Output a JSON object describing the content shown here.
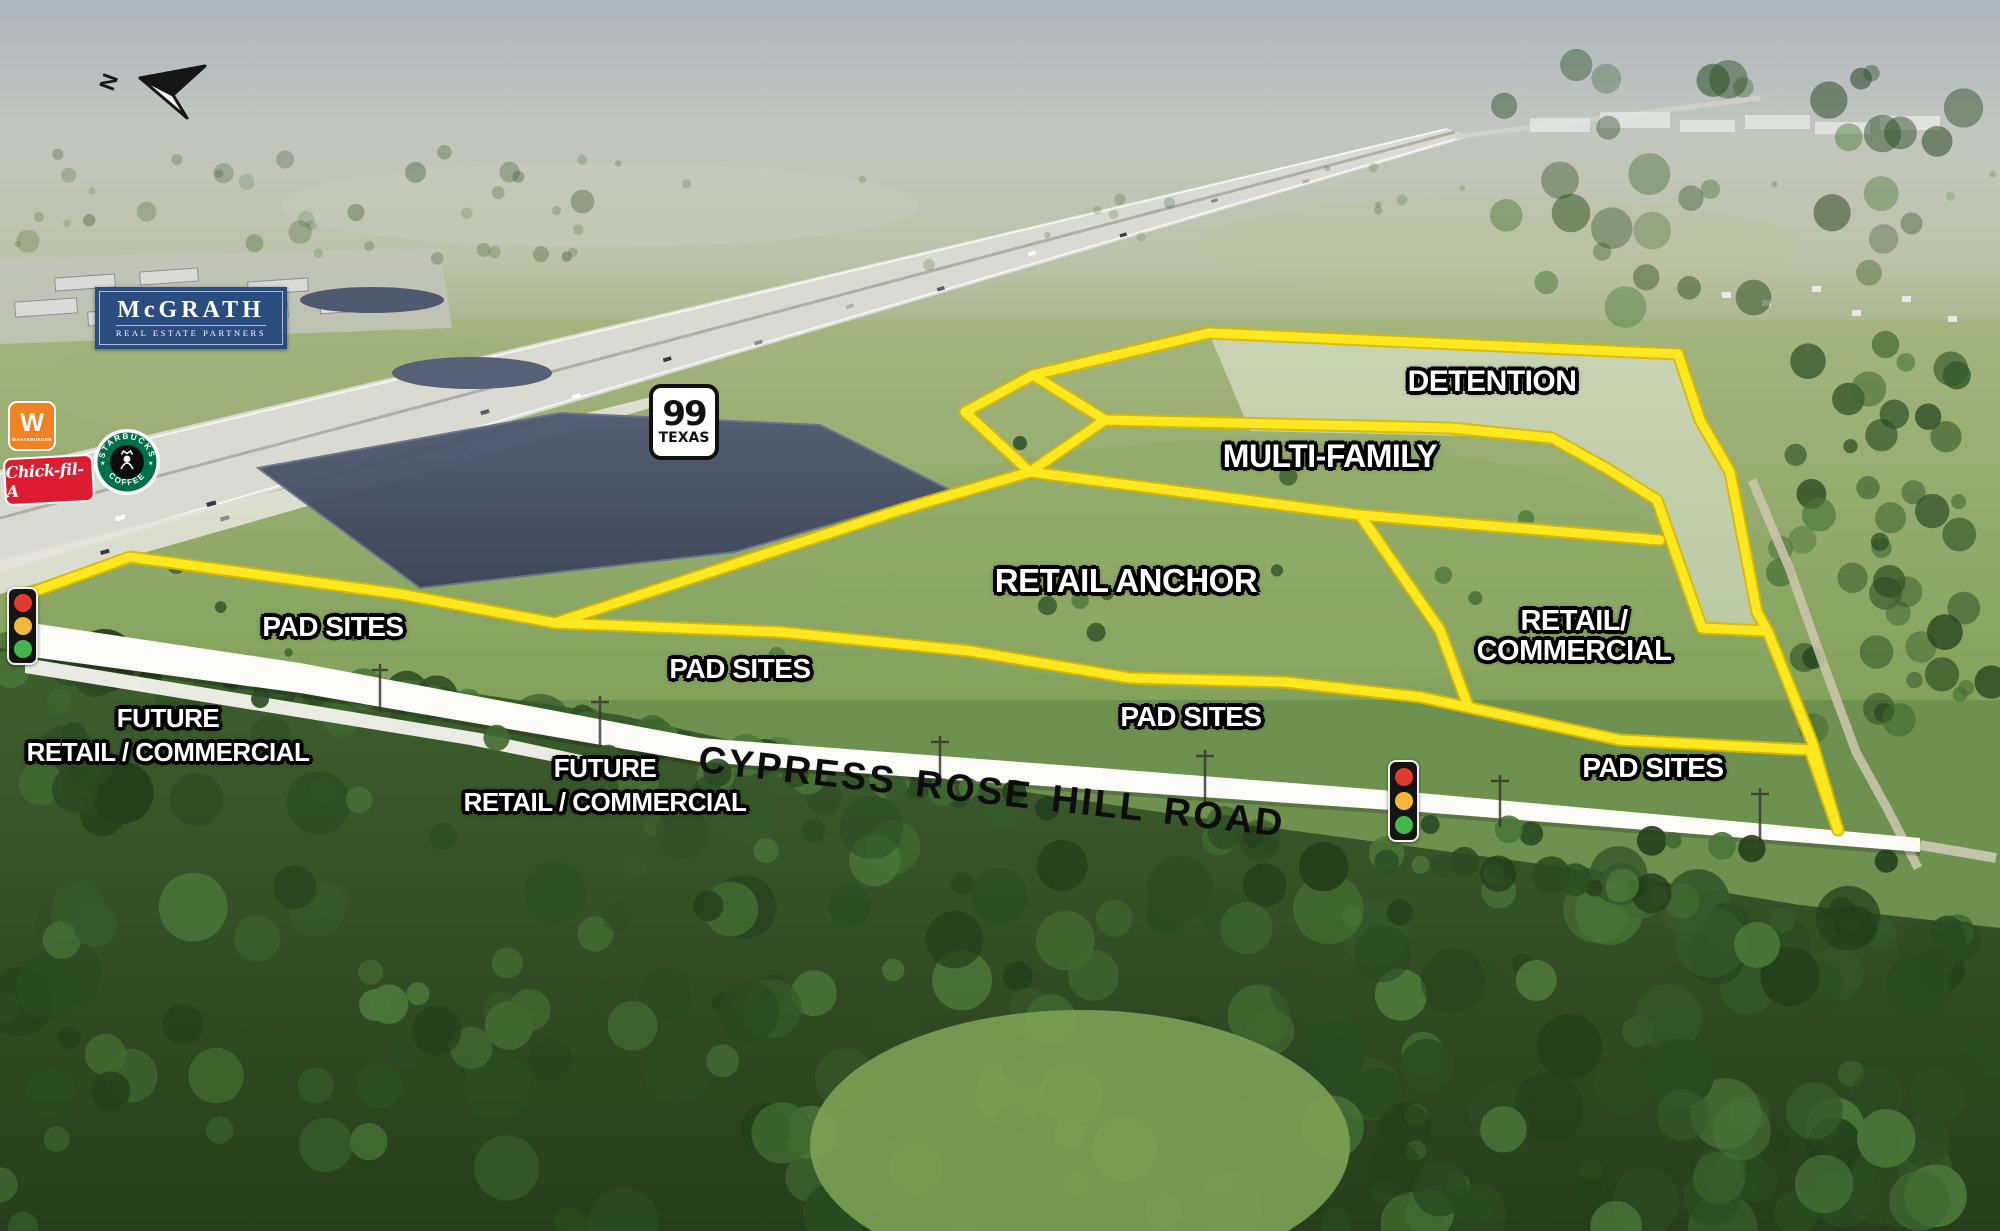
{
  "compass": {
    "label": "N"
  },
  "brands": {
    "mcgrath": {
      "name": "McGRATH",
      "subtitle": "REAL ESTATE PARTNERS"
    },
    "whataburger": {
      "initial": "W",
      "name": "WHATABURGER"
    },
    "starbucks": {
      "arc_top": "STARBUCKS",
      "arc_bottom": "COFFEE",
      "star_left": "★",
      "star_right": "★"
    },
    "chickfila": {
      "name": "Chick-fil-A"
    }
  },
  "highway_shield": {
    "number": "99",
    "state": "TEXAS"
  },
  "parcels": {
    "detention": "DETENTION",
    "multi_family": "MULTI-FAMILY",
    "retail_anchor": "RETAIL ANCHOR",
    "retail_commercial_line1": "RETAIL/",
    "retail_commercial_line2": "COMMERCIAL",
    "pad_sites": "PAD SITES"
  },
  "future_parcels": {
    "line1": "FUTURE",
    "line2": "RETAIL / COMMERCIAL"
  },
  "road": {
    "name": "CYPRESS ROSE HILL ROAD"
  },
  "colors": {
    "parcel_outline_yellow": "#ffe619",
    "road_white": "#fbfbf7",
    "label_text": "#ffffff",
    "label_outline": "#000000",
    "mcgrath_navy": "#2a4c7e",
    "whataburger_orange": "#f08223",
    "starbucks_green": "#00704a",
    "chickfila_red": "#dd1c32",
    "signal_red": "#e03a2f",
    "signal_amber": "#f4b63c",
    "signal_green": "#43b649"
  }
}
